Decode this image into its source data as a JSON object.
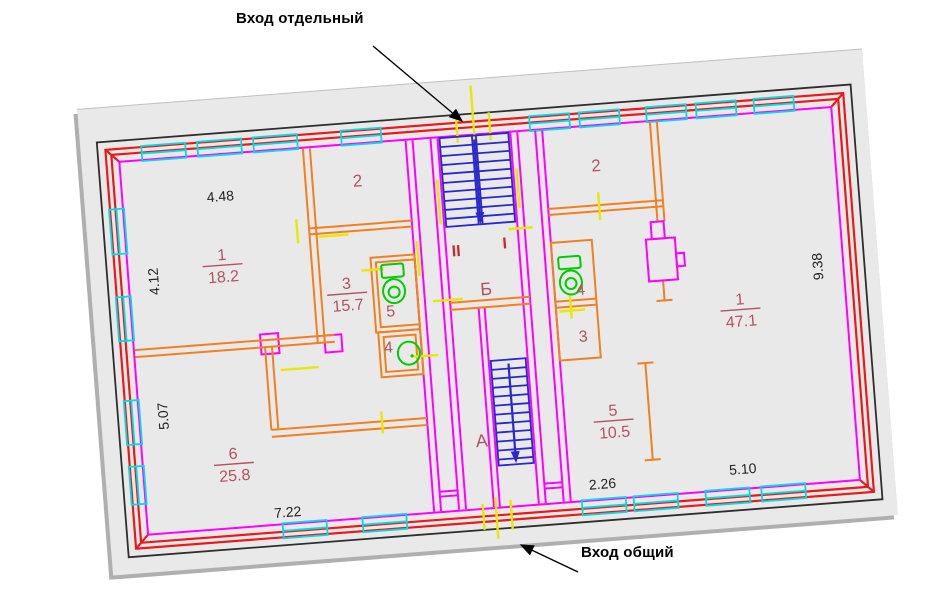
{
  "annotations": {
    "entrance_separate": "Вход отдельный",
    "entrance_common": "Вход общий"
  },
  "plan": {
    "rooms": {
      "left1": {
        "num": "1",
        "area": "18.2"
      },
      "left2": {
        "num": "2"
      },
      "left3": {
        "num": "3",
        "area": "15.7"
      },
      "left5": {
        "num": "5"
      },
      "left4": {
        "num": "4"
      },
      "left6": {
        "num": "6",
        "area": "25.8"
      },
      "right2": {
        "num": "2"
      },
      "right4": {
        "num": "4"
      },
      "right3": {
        "num": "3"
      },
      "right5": {
        "num": "5",
        "area": "10.5"
      },
      "right1": {
        "num": "1",
        "area": "47.1"
      }
    },
    "stairwell": {
      "roman_2": "II",
      "roman_1": "I",
      "letter_b": "Б",
      "letter_a": "А"
    },
    "dimensions": {
      "top_left": "4.48",
      "left_upper": "4.12",
      "left_lower": "5.07",
      "bottom_left": "7.22",
      "bottom_middle": "2.26",
      "bottom_right": "5.10",
      "right_side": "9.38"
    }
  },
  "colors": {
    "paper": "#e9e9e9",
    "outer_wall": "#e81a1a",
    "inner_wall": "#ff00ff",
    "partition": "#f08020",
    "window": "#00dde6",
    "stairs": "#2828cc",
    "fixture": "#00cc00",
    "door_mark": "#e8e800",
    "room_label": "#b4525e",
    "flight_numeral": "#cc2828",
    "dimension_text": "#222222"
  }
}
